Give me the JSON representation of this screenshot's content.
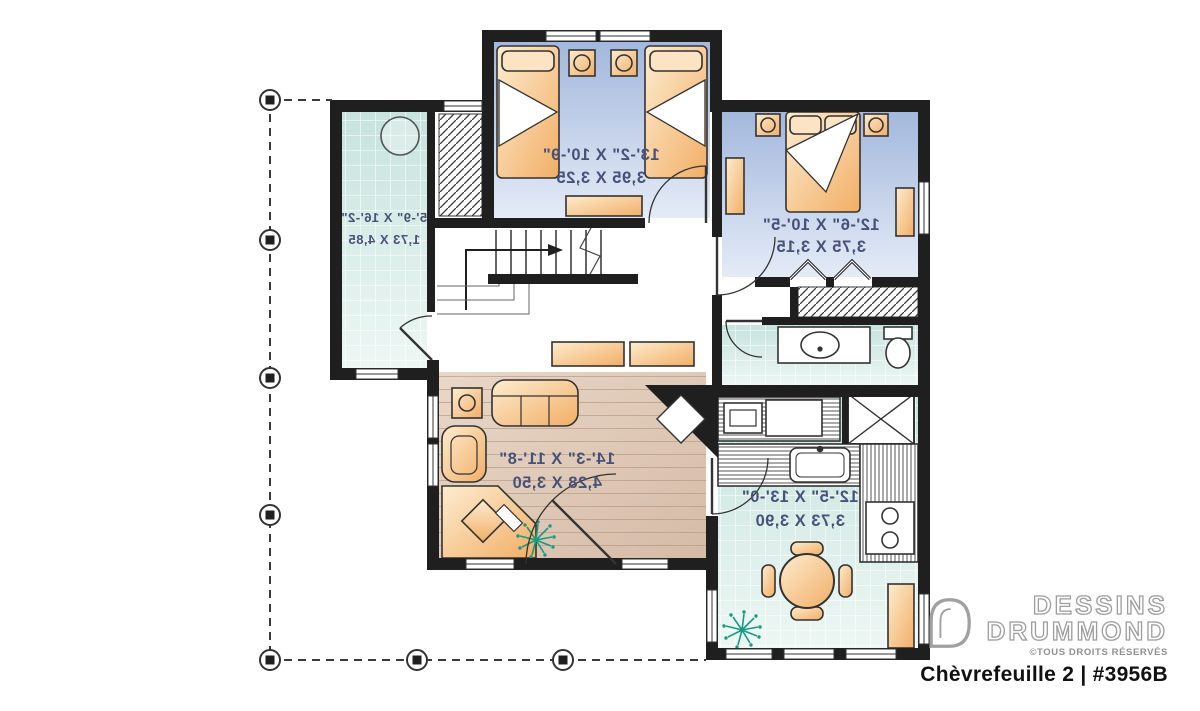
{
  "rooms": {
    "bedroom_top": {
      "imperial": "13'-2\" X 10'-9\"",
      "metric": "3,95 X 3,25"
    },
    "bedroom_master": {
      "imperial": "12'-6\" X 10'-5\"",
      "metric": "3,75 X 3,15"
    },
    "porch": {
      "imperial": "5'-9\" X 16'-2\"",
      "metric": "1,73 X 4,85"
    },
    "living": {
      "imperial": "14'-3\" X 11'-8\"",
      "metric": "4,28 X 3,50"
    },
    "kitchen": {
      "imperial": "12'-5\" X 13'-0\"",
      "metric": "3,73 X 3,90"
    }
  },
  "branding": {
    "brand_top": "DESSINS",
    "brand_bottom": "DRUMMOND",
    "rights": "©TOUS DROITS RÉSERVÉS",
    "plan_title": "Chèvrefeuille 2 | #3956B"
  },
  "colors": {
    "wall": "#1f1f1f",
    "bedroom_floor": "#a8bbdf",
    "tile_floor": "#c6e3dd",
    "wood_floor": "#e0cbba",
    "furniture": "#f5bc7c",
    "plant": "#1a9a7f",
    "label_text": "#47527a"
  }
}
